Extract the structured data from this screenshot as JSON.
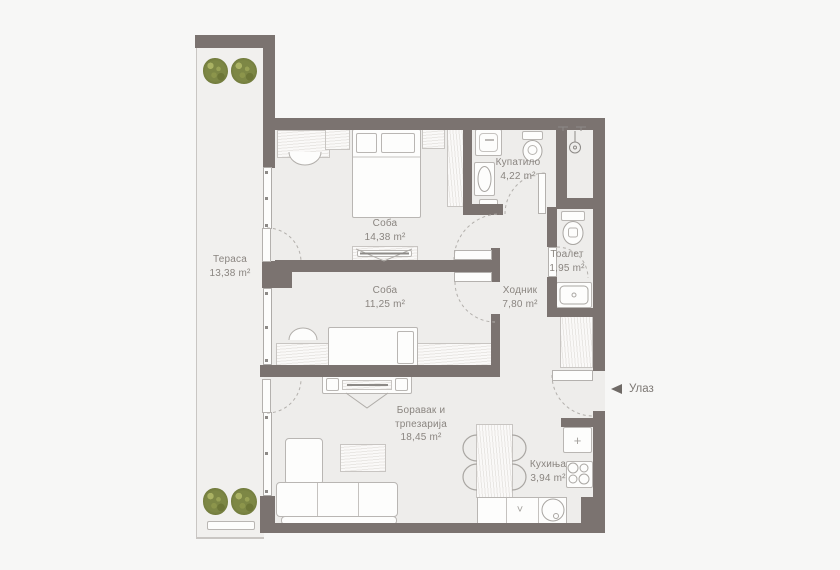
{
  "rooms": [
    {
      "id": "terrace",
      "name": "Тераса",
      "area": "13,38 m²"
    },
    {
      "id": "bedroom1",
      "name": "Соба",
      "area": "14,38 m²"
    },
    {
      "id": "bathroom",
      "name": "Купатило",
      "area": "4,22 m²"
    },
    {
      "id": "toilet",
      "name": "Тоалет",
      "area": "1,95 m²"
    },
    {
      "id": "hallway",
      "name": "Ходник",
      "area": "7,80 m²"
    },
    {
      "id": "bedroom2",
      "name": "Соба",
      "area": "11,25 m²"
    },
    {
      "id": "living",
      "name_line1": "Боравак и",
      "name_line2": "трпезарија",
      "area": "18,45 m²"
    },
    {
      "id": "kitchen",
      "name": "Кухиња",
      "area": "3,94 m²"
    }
  ],
  "entrance": {
    "label": "Улаз"
  },
  "kitchen_symbols": {
    "fridge": "+",
    "cabinet": "˅"
  },
  "colors": {
    "wall": "#7b7370",
    "floor": "#eeedeb",
    "terrace_floor": "#f1f0ee",
    "background": "#f7f7f6",
    "text": "#8a8580",
    "plant": "#7d8745"
  }
}
